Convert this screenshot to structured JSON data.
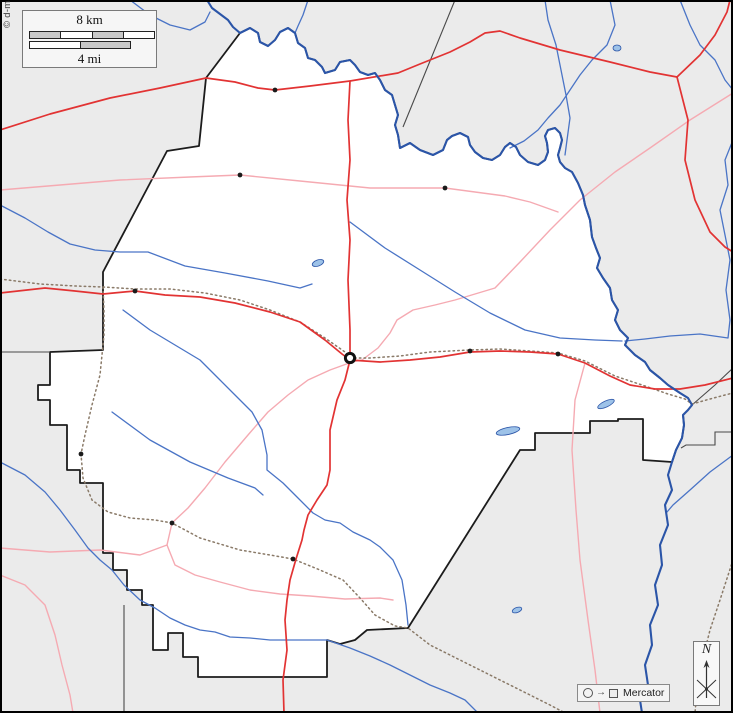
{
  "copyright": "© d-maps.com",
  "scalebar": {
    "km_label": "8 km",
    "mi_label": "4 mi",
    "km_segment_fills": [
      "#c8c8c8",
      "#ffffff",
      "#c8c8c8",
      "#ffffff"
    ],
    "mi_segment_fills": [
      "#ffffff",
      "#c8c8c8"
    ]
  },
  "north_indicator": {
    "label": "N"
  },
  "legend": {
    "symbols": [
      "circle",
      "arrow",
      "square"
    ],
    "arrow_glyph": "→",
    "projection_label": "Mercator"
  },
  "colors": {
    "outside_fill": "#ebebeb",
    "county_fill": "#ffffff",
    "county_border": "#1c1c1c",
    "neighbor_border": "#4a4a4a",
    "river_major": "#2b55a8",
    "river_minor": "#4a74c6",
    "lake_fill": "#9dc2e8",
    "lake_stroke": "#2b55a8",
    "road_major": "#e23333",
    "road_minor": "#f5aab2",
    "railroad": "#8a7a68",
    "town": "#1a1a1a",
    "frame": "#000000"
  },
  "map": {
    "width": 733,
    "height": 713,
    "county_outline": "M240,33 L206,78 L199,146 L167,151 L103,272 L103,350 L50,352 L50,385 L38,385 L38,400 L50,400 L50,425 L67,425 L67,470 L80,470 L80,483 L103,483 L103,553 L113,553 L113,570 L127,570 L127,590 L142,590 L142,605 L153,605 L153,650 L168,650 L168,633 L183,633 L183,657 L198,657 L198,677 L327,677 L327,640 L340,644 L355,640 L367,630 L408,628 L520,450 L535,450 L535,433 L590,433 L590,421 L618,421 L618,419 L643,419 L643,460 L672,462 L676,450 L682,438 L684,425 L683,415 L688,410 L692,405 L688,398 L680,393 L668,385 L660,378 L650,370 L645,362 L635,355 L625,345 L628,338 L620,330 L615,320 L618,310 L612,300 L610,288 L603,278 L597,268 L600,258 L596,248 L592,237 L590,220 L585,205 L583,195 L578,183 L572,172 L565,168 L560,162 L558,155 L560,148 L562,140 L560,133 L555,128 L548,130 L545,136 L547,143 L548,152 L545,160 L538,165 L528,162 L520,155 L516,147 L510,143 L505,147 L500,155 L492,160 L483,158 L475,152 L470,145 L468,137 L460,133 L452,136 L447,140 L443,150 L433,155 L420,150 L410,143 L400,148 L398,135 L395,125 L398,115 L395,105 L392,95 L385,90 L380,80 L375,73 L368,75 L360,72 L355,65 L350,60 L340,62 L335,70 L325,73 L322,67 L315,60 L308,58 L305,48 L298,43 L295,33 L288,28 L280,32 L275,40 L268,46 L260,42 L258,33 L250,28 Z",
    "neighbor_lines": [
      "M455,0 L403,127",
      "M692,405 L715,385 L733,368",
      "M733,432 L715,432 L715,445 L686,445 L681,448",
      "M0,352 L50,352",
      "M124,605 L124,713"
    ],
    "river_major_paths": [
      "M207,0 L212,8 L220,14 L228,20 L233,27 L240,33 L250,28 L258,33 L260,42 L268,46 L275,40 L280,32 L288,28 L295,33 L298,43 L305,48 L308,58 L315,60 L322,67 L325,73 L335,70 L340,62 L350,60 L355,65 L360,72 L368,75 L375,73 L380,80 L385,90 L392,95 L395,105 L398,115 L395,125 L398,135 L400,148 L410,143 L420,150 L433,155 L443,150 L447,140 L452,136 L460,133 L468,137 L470,145 L475,152 L483,158 L492,160 L500,155 L505,147 L510,143 L516,147 L520,155 L528,162 L538,165 L545,160 L548,152 L547,143 L545,136 L548,130 L555,128 L560,133 L562,140 L560,148 L558,155 L560,162 L565,168 L572,172 L578,183 L583,195 L585,205 L590,220 L592,237 L596,248 L600,258 L597,268 L603,278 L610,288 L612,300 L618,310 L615,320 L620,330 L628,338 L625,345 L635,355 L645,362 L650,370 L660,378 L668,385 L680,393 L688,398 L692,405 L688,410 L683,415 L684,425 L682,438 L676,450 L672,462 L668,475 L672,490 L665,505 L668,525 L660,545 L662,565 L655,585 L658,605 L650,625 L652,645 L645,665 L648,685 L640,700 L642,713"
    ],
    "river_minor_paths": [
      "M308,0 L303,15 L298,26 L295,33",
      "M130,0 L150,15 L170,25 L190,30 L205,22 L210,12",
      "M610,0 L615,25 L607,45 L592,60 L580,75 L570,90 L560,105 L548,118 L538,130 L524,141 L510,148",
      "M545,0 L548,20 L556,45 L561,70 L566,95 L570,118 L567,140 L565,155",
      "M680,0 L690,25 L700,45 L715,60 L725,80 L733,90",
      "M733,140 L725,160 L728,185 L720,210 L725,235 L730,260 L726,290 L730,320 L728,338 L700,334 L670,336 L645,339 L625,341",
      "M350,222 L385,248 L420,270 L455,292 L490,313 L525,330 L560,338 L595,340 L622,341",
      "M0,205 L25,218 L48,232 L70,244 L95,250 L120,252 L148,252 L185,266 L225,273 L268,281 L300,288 L312,284",
      "M123,310 L150,330 L175,345 L200,360 L220,380 L235,395 L252,412 L262,430 L267,455 L267,470 L283,483 L297,497 L313,513 L325,520 L340,523 L353,532 L370,540 L380,547 L393,560 L402,580 L406,605 L408,625",
      "M112,412 L150,440 L190,462 L228,478 L255,488 L263,495",
      "M0,462 L25,475 L45,492 L60,510 L75,530 L88,548 L100,560 L112,570 L124,585 L140,600 L155,608 L170,618 L185,625 L200,630 L215,632 L230,637 L250,638 L270,640 L290,640 L310,640 L327,640 L350,648 L370,656 L390,665 L410,675 L430,685 L450,693 L465,700 L478,713",
      "M733,455 L710,472 L690,490 L673,505 L667,512"
    ],
    "lakes": [
      {
        "cx": 318,
        "cy": 263,
        "rx": 6,
        "ry": 3,
        "rot": -20
      },
      {
        "cx": 508,
        "cy": 431,
        "rx": 12,
        "ry": 3.5,
        "rot": -12
      },
      {
        "cx": 606,
        "cy": 404,
        "rx": 9,
        "ry": 3,
        "rot": -25
      },
      {
        "cx": 517,
        "cy": 610,
        "rx": 5,
        "ry": 2.5,
        "rot": -20
      },
      {
        "cx": 617,
        "cy": 48,
        "rx": 4,
        "ry": 3,
        "rot": 0
      }
    ],
    "road_major_paths": [
      "M0,130 L50,114 L110,98 L160,88 L206,78 L235,82 L258,88 L275,90 L310,86 L350,81 L398,73 L420,64 L450,52 L470,42 L485,33 L500,31 L520,38 L560,50 L610,62 L650,72 L677,77",
      "M677,77 L700,55 L715,35 L727,12 L730,0",
      "M677,77 L688,120 L685,160 L695,200 L710,232 L725,247 L733,252",
      "M0,293 L45,288 L75,291 L103,294 L135,291 L165,295 L200,297 L235,303 L270,312 L300,322 L325,340 L342,354 L350,360",
      "M350,360 L380,362 L410,360 L440,357 L470,352 L500,351 L530,352 L558,354 L585,363 L610,376 L630,385 L655,389 L680,389 L705,385 L733,378",
      "M350,81 L348,120 L350,160 L347,200 L350,240 L348,280 L350,330 L350,360 L345,380 L337,400 L330,430 L330,470 L327,485 L317,500 L308,515 L304,530 L302,540 L296,559 L290,580 L287,600 L285,620 L287,650 L283,680 L284,713"
    ],
    "road_minor_paths": [
      "M0,190 L60,185 L120,180 L190,177 L240,175 L300,181 L370,188 L445,188 L505,196 L530,202 L558,212",
      "M733,93 L690,120 L650,148 L615,172 L580,200 L550,230 L520,262 L495,288 L455,300 L435,305 L413,310 L397,320 L390,333 L378,348 L362,360 L352,362",
      "M352,362 L330,370 L308,380 L288,395 L268,412 L248,435 L225,462 L205,488 L188,508 L172,523 L167,545 L175,565 L195,575 L220,582 L250,590 L280,594 L310,596 L345,599 L380,598 L393,600",
      "M0,548 L50,552 L100,550 L140,555 L167,545",
      "M0,575 L25,585 L45,605 L55,635 L62,665 L70,695 L73,713",
      "M585,363 L575,400 L572,450 L576,510 L580,560 L588,620 L595,670 L600,713"
    ],
    "railroad_paths": [
      "M0,279 L40,284 L75,286 L103,287 L135,289 L170,289 L205,293 L240,300 L270,310 L300,322 L325,338 L345,352 L352,358 L370,358 L400,356 L430,352 L470,350 L500,349 L530,351 L558,353 L585,361 L615,376 L645,386 L668,394 L685,399 L692,404 L710,399 L725,395 L733,393",
      "M103,287 L104,310 L104,335 L102,355 L100,375 L92,405 L85,435 L81,454 L83,478 L92,500 L108,512 L130,518 L155,520 L172,523 L200,538 L240,550 L270,555 L293,559 L320,570 L343,580 L360,598 L375,615 L395,626 L408,628 L430,645 L460,660 L490,675 L520,690 L550,705 L565,713",
      "M733,560 L720,600 L710,630 L702,662 L697,690 L695,713"
    ],
    "towns": [
      [
        275,
        90
      ],
      [
        240,
        175
      ],
      [
        445,
        188
      ],
      [
        135,
        291
      ],
      [
        470,
        351
      ],
      [
        558,
        354
      ],
      [
        81,
        454
      ],
      [
        172,
        523
      ],
      [
        293,
        559
      ]
    ],
    "county_seat": [
      350,
      358
    ]
  }
}
